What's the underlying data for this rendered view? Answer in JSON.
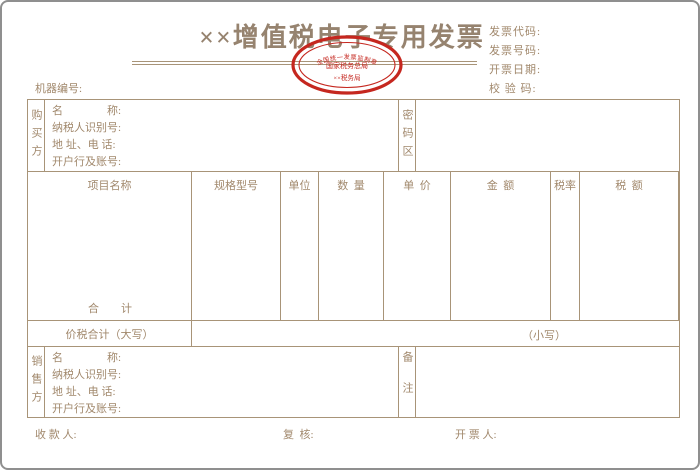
{
  "page": {
    "title": "××增值税电子专用发票",
    "header_right": {
      "rows": [
        "发票代码:",
        "发票号码:",
        "开票日期:",
        "校 验 码:"
      ]
    },
    "machine_label": "机器编号:",
    "stamp": {
      "arc": "全国统一发票监制章",
      "middle": "国家税务总局",
      "bottom": "××税务局"
    },
    "buyer": {
      "side": "购买方",
      "rows": [
        "名　　　　称:",
        "纳税人识别号:",
        "地 址、电 话:",
        "开户行及账号:"
      ]
    },
    "password_label": "密码区",
    "table": {
      "headers": [
        "项目名称",
        "规格型号",
        "单位",
        "数  量",
        "单  价",
        "金  额",
        "税率",
        "税  额"
      ],
      "total_label": "合　　计"
    },
    "sum_row": {
      "label": "价税合计（大写）",
      "small": "（小写）"
    },
    "seller": {
      "side": "销售方",
      "rows": [
        "名　　　　称:",
        "纳税人识别号:",
        "地 址、电 话:",
        "开户行及账号:"
      ]
    },
    "remarks_label": "备注",
    "footer": {
      "payee": "收 款 人:",
      "checker": "复  核:",
      "drawer": "开 票 人:"
    },
    "colors": {
      "line": "#a89478",
      "text": "#a1886c",
      "stamp_red": "#c5271f"
    }
  }
}
